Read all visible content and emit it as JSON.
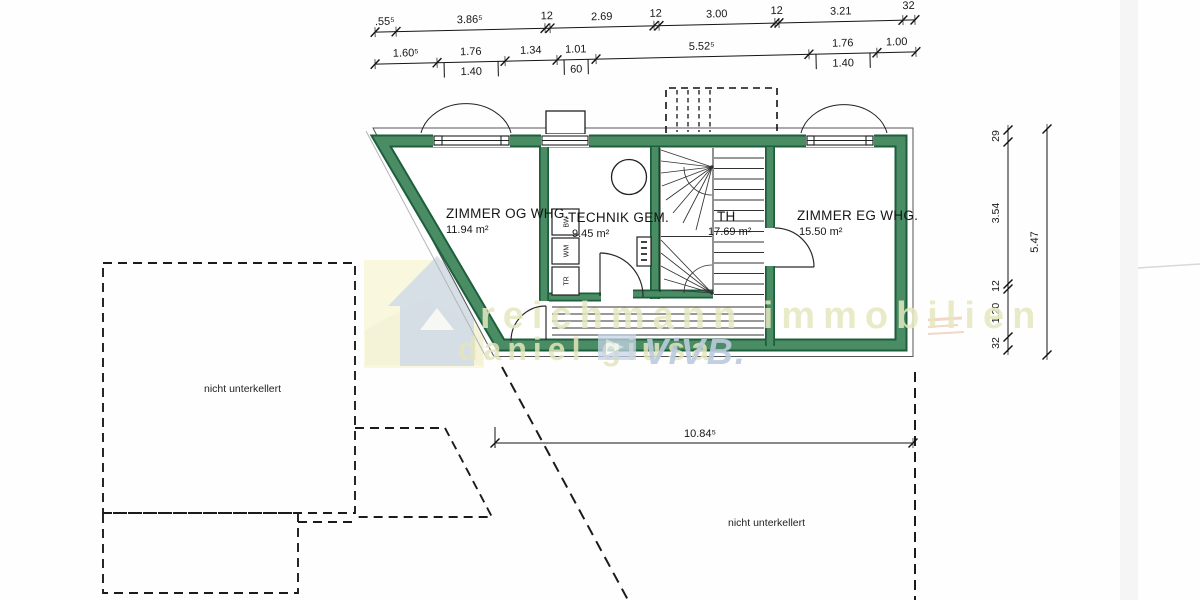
{
  "scan": {
    "watermark": {
      "line1": "reichmann immobilien",
      "line2": "daniel giusa",
      "brand": "ViVB."
    },
    "colors": {
      "wall_green": "#4a8c63",
      "wall_green_dark": "#1d5e3c",
      "watermark_yellow": "#e6e8bf",
      "watermark_blue": "#bccbdf"
    }
  },
  "rooms": [
    {
      "name": "ZIMMER OG WHG.",
      "area": "11.94 m²"
    },
    {
      "name": "TECHNIK GEM.",
      "area": "9.45 m²"
    },
    {
      "name": "TH",
      "area": "17.69 m²"
    },
    {
      "name": "ZIMMER EG WHG.",
      "area": "15.50 m²"
    }
  ],
  "appliances": {
    "box1": "BW",
    "box2": "WM",
    "box3": "TR"
  },
  "notes": {
    "left": "nicht unterkellert",
    "right": "nicht unterkellert"
  },
  "dims": {
    "top": [
      ".55⁵",
      "3.86⁵",
      "12",
      "2.69",
      "12",
      "3.00",
      "12",
      "3.21",
      "32"
    ],
    "second": [
      "1.60⁵",
      "1.76",
      "1.34",
      "1.01",
      "5.52⁵",
      "1.76",
      "1.00"
    ],
    "sub": [
      "1.40",
      "60",
      "1.40"
    ],
    "right": [
      "29",
      "3.54",
      "12",
      "1.20",
      "32"
    ],
    "right_total": "5.47",
    "bottom_total": "10.84⁵"
  }
}
